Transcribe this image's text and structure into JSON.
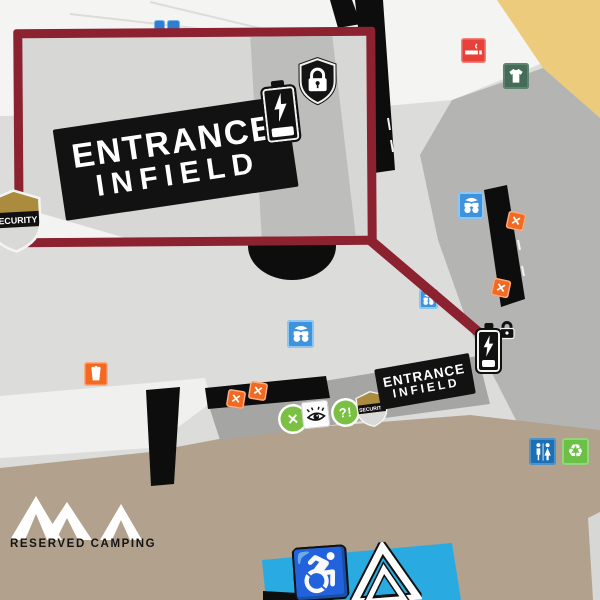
{
  "callout": {
    "stamp_line1": "ENTRANCE",
    "stamp_line2": "INFIELD",
    "security_label": "SECURITY"
  },
  "infield": {
    "stamp_line1": "ENTRANCE",
    "stamp_line2": "INFIELD",
    "security_label": "SECURITY"
  },
  "camping": {
    "label": "RESERVED CAMPING"
  },
  "glyphs": {
    "x": "✕",
    "help": "?!",
    "recycle": "♻",
    "wheelchair": "♿"
  },
  "colors": {
    "callout_red": "#8c2130",
    "food_orange": "#f26a21",
    "info_blue": "#3f93dd",
    "smoking_red": "#e8413a",
    "merch_green": "#456b59",
    "restroom_blue": "#1b6fb5",
    "recycle_green": "#6cbf47",
    "accessible_blue": "#29abe2",
    "sand": "#eccb7d",
    "taupe": "#b2a18c"
  }
}
